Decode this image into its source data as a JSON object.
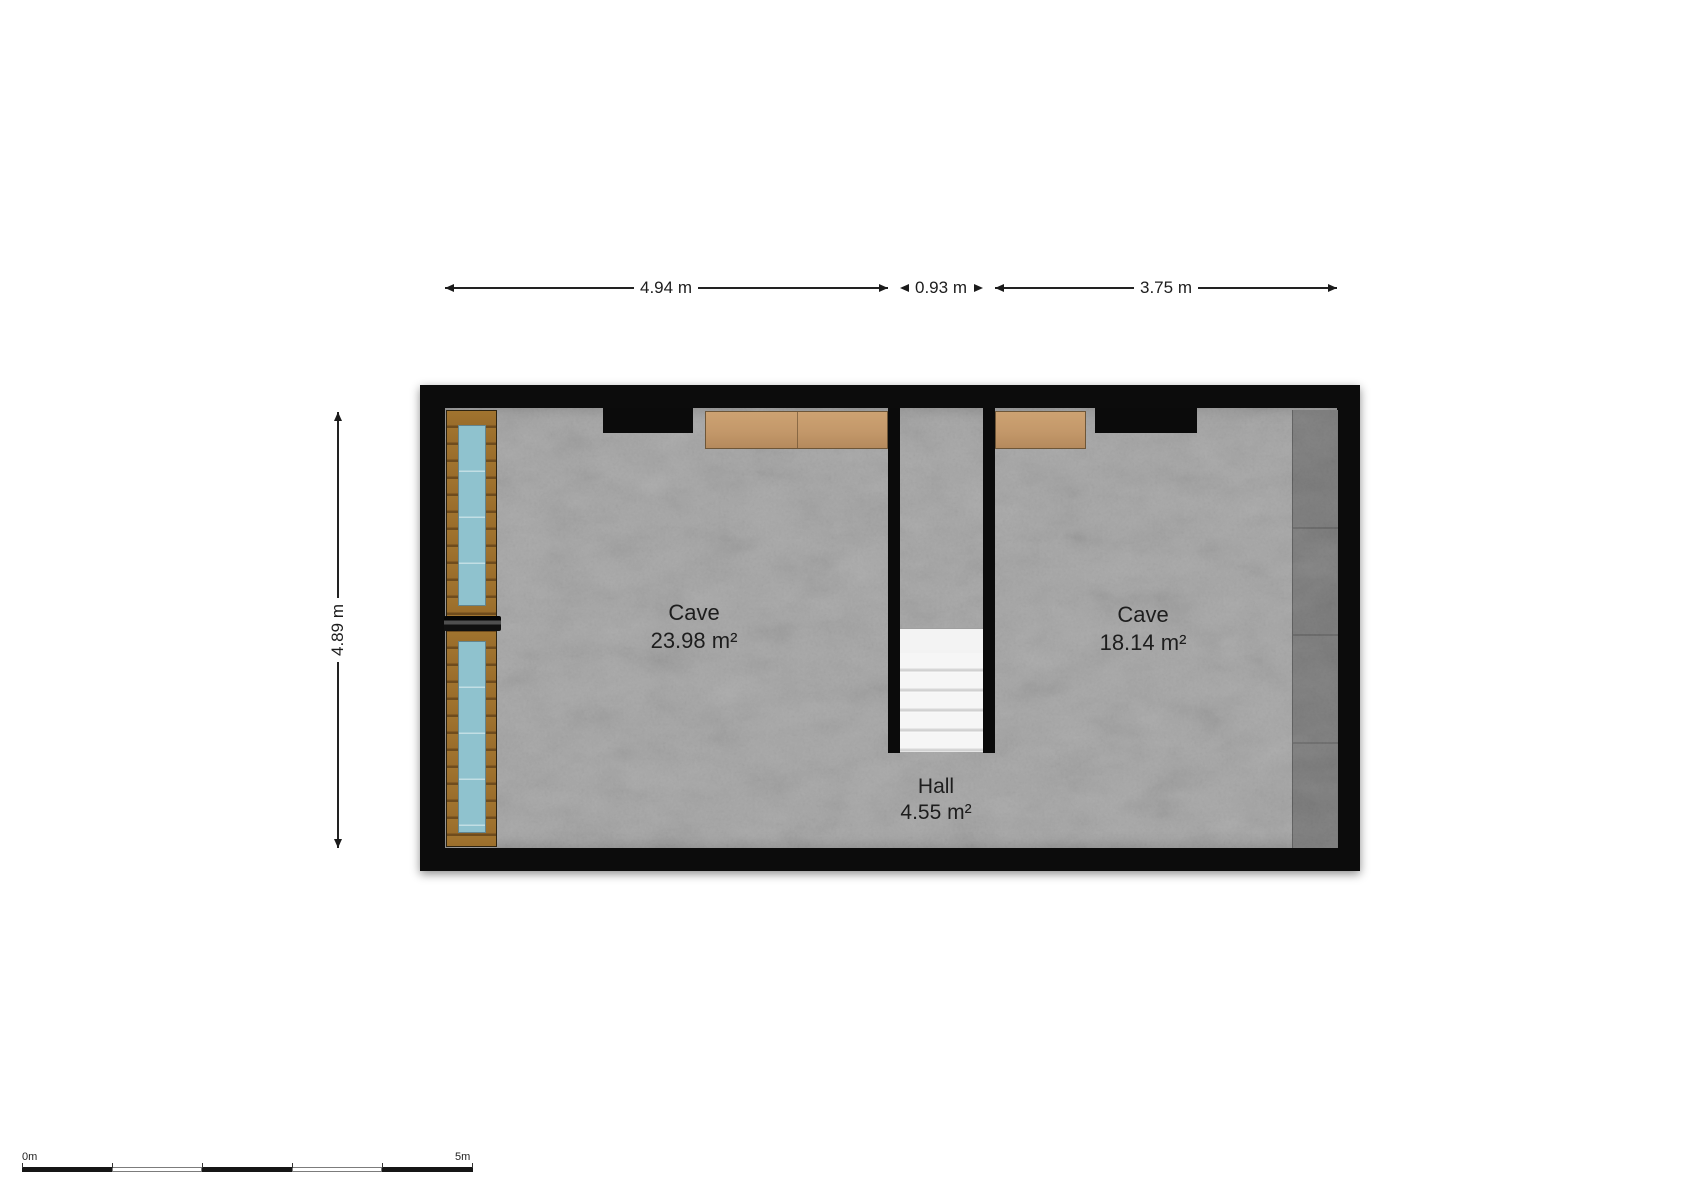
{
  "plan": {
    "rooms": [
      {
        "name": "Cave",
        "area": "23.98 m²"
      },
      {
        "name": "Cave",
        "area": "18.14 m²"
      },
      {
        "name": "Hall",
        "area": "4.55 m²"
      }
    ],
    "dimensions": {
      "top_left": "4.94 m",
      "top_middle": "0.93 m",
      "top_right": "3.75 m",
      "left": "4.89 m"
    },
    "scale_bar": {
      "start_label": "0m",
      "end_label": "5m"
    },
    "colors": {
      "wall": "#0c0c0c",
      "floor": "#aaaaaa",
      "wood_beam": "#c3986a",
      "window_frame_wood": "#9a6d2b",
      "window_glass": "#8fc2ce",
      "right_ledge": "#7e7e7e",
      "stairs": "#f3f3f3"
    }
  }
}
